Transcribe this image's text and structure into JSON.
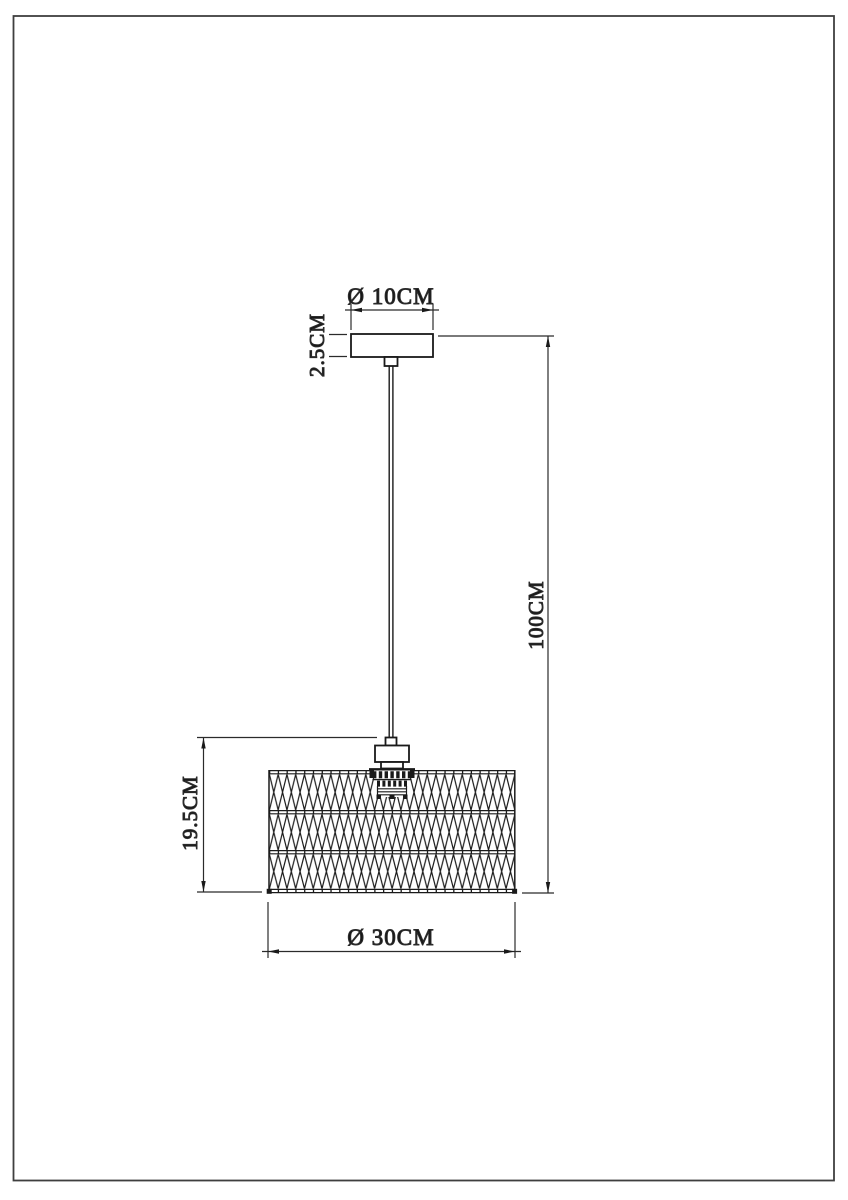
{
  "drawing": {
    "type": "pendant-lamp-dimension-drawing",
    "dimensions": {
      "canopy_diameter": "Ø 10CM",
      "canopy_height": "2.5CM",
      "suspension_height": "100CM",
      "shade_height": "19.5CM",
      "shade_diameter": "Ø 30CM"
    }
  },
  "colors": {
    "line": "#1a1a1a",
    "dimension_line": "#2b2b2b",
    "border": "#3f3f3f",
    "background": "#ffffff"
  }
}
